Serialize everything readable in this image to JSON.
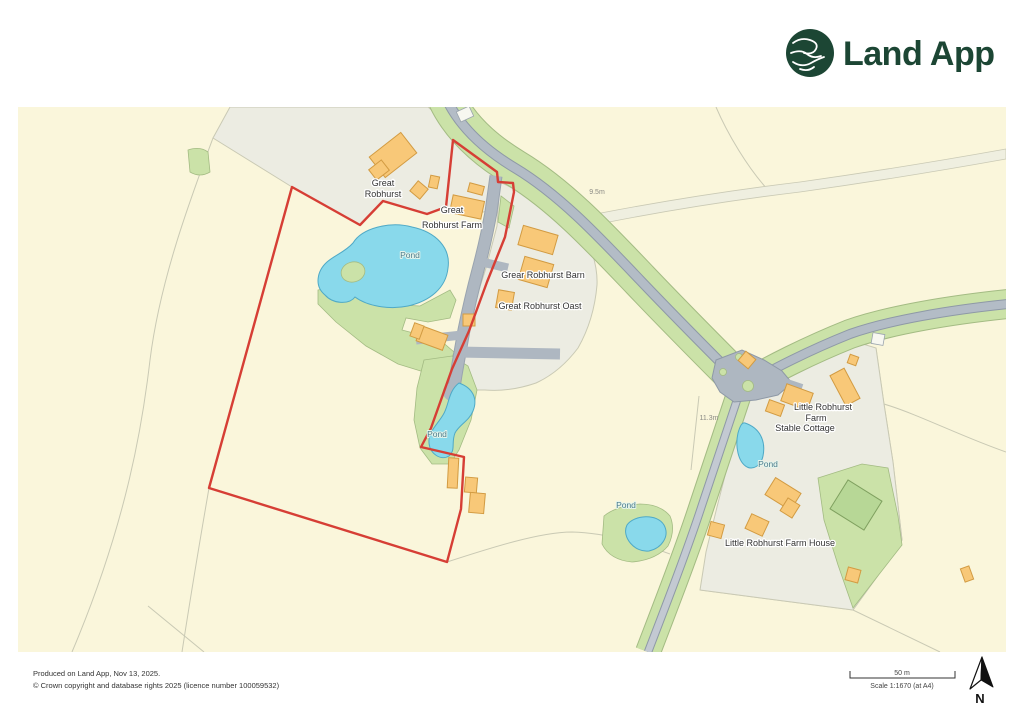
{
  "header": {
    "brand": "Land App"
  },
  "map": {
    "place_labels": [
      "Great",
      "Robhurst",
      "Great",
      "Robhurst Farm",
      "Grear Robhurst Barn",
      "Great Robhurst Oast",
      "Little Robhurst",
      "Farm",
      "Stable Cottage",
      "Little Robhurst Farm House"
    ],
    "water_labels": [
      "Pond",
      "Pond",
      "Pond",
      "Pond"
    ],
    "road_labels": [
      "9.5m",
      "11.3m"
    ]
  },
  "footer": {
    "produced": "Produced on Land App, Nov 13, 2025.",
    "copyright": "© Crown copyright and database rights 2025 (licence number 100059532)",
    "scale_bar": "50 m",
    "scale": "Scale 1:1670 (at A4)",
    "north": "N"
  },
  "colors": {
    "field_cream": "#FAF6DB",
    "grounds_gray": "#ECECE2",
    "green_area": "#CBE2A8",
    "verge_casing": "#A3BB83",
    "court_green": "#B7D796",
    "court_stroke": "#7FA05F",
    "pond_blue": "#89D9EB",
    "pond_stroke": "#4FA9C6",
    "building_orange": "#F8C878",
    "building_stroke": "#D29B42",
    "white_building": "#F7F7F0",
    "road_fill": "#B3BCC6",
    "road_minor": "#C3C9D2",
    "road_casing": "#8E99A6",
    "driveway_gray": "#AEB7C1",
    "boundary_red": "#D63E35",
    "label_dark": "#333333",
    "water_label": "#4E7D8E",
    "annotation_gray": "#8B8B85",
    "faint_line": "#C9C9B4",
    "track_fill": "#EFEFE0",
    "brand_green": "#1C4634"
  }
}
